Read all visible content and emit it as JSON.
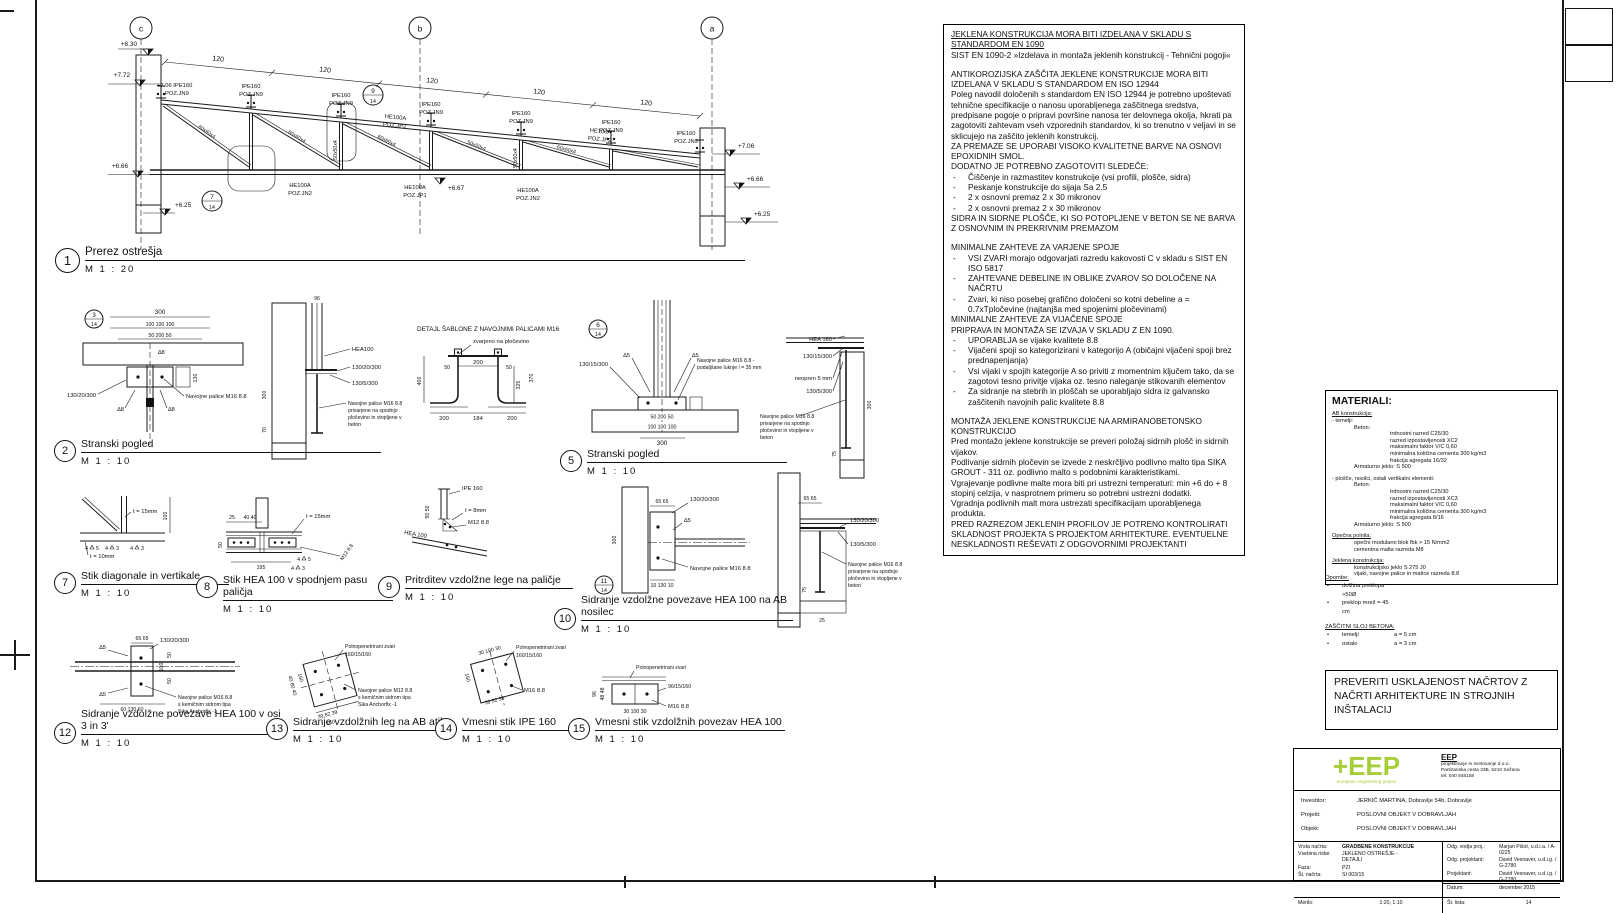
{
  "sheet": {
    "bg": "#ffffff",
    "line_color": "#1a1a1a",
    "accent_green": "#a6ce39"
  },
  "main": {
    "grid_c": "c",
    "grid_b": "b",
    "grid_a": "a",
    "dim120": "120",
    "lev_830": "+8.30",
    "lev_772": "+7.72",
    "lev_706": "+7.06",
    "lev_666": "+6.66",
    "lev_625": "+6.25",
    "lev_667": "+6.67",
    "lv706_ipe": "+7.06 IPE160",
    "purlin1": "IPE160",
    "purlin2": "POZ.JN9",
    "jn2a": "HE100A",
    "jn2b": "POZ.JN2",
    "jp1a": "HE100A",
    "jp1b": "POZ.JP1",
    "jp2a": "HE100A",
    "jp2b": "POZ.JP2",
    "d60": "60x60x4",
    "d50": "50x50x4"
  },
  "details": {
    "refs": {
      "r3": "3",
      "r6": "6",
      "r11": "11",
      "sheet": "14"
    },
    "d1": {
      "num": "1",
      "title": "Prerez ostrešja",
      "scale": "M  1 : 20"
    },
    "d2": {
      "num": "2",
      "title": "Stranski pogled",
      "scale": "M  1 : 10"
    },
    "d5": {
      "num": "5",
      "title": "Stranski pogled",
      "scale": "M  1 : 10"
    },
    "d7": {
      "num": "7",
      "title": "Stik diagonale in vertikale",
      "scale": "M  1 : 10"
    },
    "d8": {
      "num": "8",
      "title": "Stik HEA 100 v spodnjem pasu paličja",
      "scale": "M  1 : 10"
    },
    "d9": {
      "num": "9",
      "title": "Pritrditev vzdolžne lege na paličje",
      "scale": "M  1 : 10"
    },
    "d10": {
      "num": "10",
      "title": "Sidranje vzdolžne povezave HEA 100 na AB nosilec",
      "scale": "M  1 : 10"
    },
    "d12": {
      "num": "12",
      "title": "Sidranje vzdolžne povezave HEA 100 v osi 3 in 3'",
      "scale": "M  1 : 10"
    },
    "d13": {
      "num": "13",
      "title": "Sidranje vzdolžnih leg na AB atiko",
      "scale": "M  1 : 10"
    },
    "d14": {
      "num": "14",
      "title": "Vmesni stik IPE 160",
      "scale": "M  1 : 10"
    },
    "d15": {
      "num": "15",
      "title": "Vmesni stik vzdolžnih povezav HEA 100",
      "scale": "M  1 : 10"
    }
  },
  "sablona": {
    "title": "DETAJL ŠABLONE Z NAVOJNIMI PALICAMI M16",
    "weld_note": "zvarjeno na pločevino"
  },
  "ann": {
    "a300": "300",
    "a100x3": "100   100   100",
    "a50_200_50": "50   200   50",
    "a130_20_300": "130/20/300",
    "a130_5_300": "130/5/300",
    "a130_15_300": "130/15/300",
    "navm16": "Navojne palice M16 8.8",
    "priv_l2": "privarjene na spodnjo",
    "priv_l3": "pločevino in vtopljene v",
    "priv_l4": "beton",
    "podaljsane1": "Navojne palice M16 8.8 -",
    "podaljsane2": "podaljšane luknje l = 35 mm",
    "sika2": "s kemičnim sidrom tipa",
    "sika3": "Sika Anchorfix -1",
    "sika_m12": "Navojne palice M12 8.8",
    "hea100": "HEA100",
    "hea100s": "HEA 100",
    "hea160": "HEA 160",
    "ipe160": "IPE 160",
    "neopren": "neopren 5 mm",
    "t15": "t = 15mm",
    "t10": "t = 10mm",
    "t8": "t = 8mm",
    "m12": "M12 8.8",
    "m16": "M16 8.8",
    "poln": "Polnopenetrirani zvari",
    "p160": "160/15/160",
    "p96": "96/15/160",
    "a400": "400",
    "a325": "325",
    "a370": "370",
    "a200": "200",
    "a184": "184",
    "a50": "50",
    "a195": "195",
    "a25": "25",
    "a40_40": "40  40",
    "a100": "100",
    "a130": "130",
    "a70": "70",
    "a65_65": "65  65",
    "a60_130_60": "60  130  60",
    "a10_130_10": "10 130 10",
    "a30_100_30": "30 100 30",
    "a39_82_39": "39 82 39",
    "a40_80_40": "40 80 40",
    "a160": "160",
    "a96": "96",
    "a48_48": "48 48",
    "a75": "75",
    "a50_50": "50 50",
    "w5t": "∆5",
    "w8t": "∆8",
    "w4": "4",
    "w3": "3",
    "w5": "5"
  },
  "specs": {
    "lines": [
      {
        "s": "hu",
        "t": "JEKLENA KONSTRUKCIJA MORA BITI IZDELANA V SKLADU S STANDARDOM EN 1090"
      },
      {
        "s": "p",
        "t": "SIST EN 1090-2 »Izdelava in montaža jeklenih konstrukcij - Tehnični pogoji«"
      },
      {
        "s": "gap"
      },
      {
        "s": "p",
        "t": "ANTIKOROZIJSKA ZAŠČITA JEKLENE KONSTRUKCIJE MORA BITI IZDELANA V SKLADU S STANDARDOM EN ISO 12944"
      },
      {
        "s": "p",
        "t": "Poleg navodil določenih s standardom EN ISO 12944 je potrebno upoštevati tehnične specifikacije o nanosu uporabljenega zaščitnega sredstva, predpisane pogoje o pripravi površine nanosa ter delovnega okolja, hkrati pa zagotoviti zahtevam vseh vzporednih standardov, ki so trenutno v veljavi in se sklicujejo na zaščito jeklenih konstrukcij."
      },
      {
        "s": "p",
        "t": "ZA PREMAZE SE UPORABI VISOKO KVALITETNE BARVE NA OSNOVI EPOXIDNIH SMOL."
      },
      {
        "s": "p",
        "t": "DODATNO JE POTREBNO ZAGOTOVITI SLEDEČE:"
      },
      {
        "s": "li",
        "t": "Čiščenje in razmastitev konstrukcije (vsi profili, plošče, sidra)"
      },
      {
        "s": "li",
        "t": "Peskanje konstrukcije do sijaja Sa 2.5"
      },
      {
        "s": "li",
        "t": "2 x osnovni premaz 2 x 30 mikronov"
      },
      {
        "s": "li",
        "t": "2 x osnovni premaz 2 x 30 mikronov"
      },
      {
        "s": "p",
        "t": "SIDRA IN SIDRNE PLOŠČE, KI SO POTOPLJENE V BETON SE NE BARVA Z OSNOVNIM IN PREKRIVNIM PREMAZOM"
      },
      {
        "s": "gap"
      },
      {
        "s": "p",
        "t": "MINIMALNE ZAHTEVE ZA VARJENE SPOJE"
      },
      {
        "s": "li",
        "t": "VSI ZVARI morajo odgovarjati razredu kakovosti C v skladu s SIST EN ISO 5817"
      },
      {
        "s": "li",
        "t": "ZAHTEVANE DEBELINE IN OBLIKE ZVAROV SO DOLOČENE NA NAČRTU"
      },
      {
        "s": "li",
        "t": "Zvari, ki niso posebej grafično določeni so kotni debeline a = 0.7xTpločevine (najtanjša med spojenimi pločevinami)"
      },
      {
        "s": "p",
        "t": "MINIMALNE ZAHTEVE ZA VIJAČENE SPOJE"
      },
      {
        "s": "p",
        "t": "PRIPRAVA IN MONTAŽA SE IZVAJA V SKLADU Z EN 1090."
      },
      {
        "s": "li",
        "t": "UPORABLJA se vijake kvalitete 8.8"
      },
      {
        "s": "li",
        "t": "Vijačeni spoji so kategorizirani v kategorijo A (običajni vijačeni spoji brez prednapenjanja)"
      },
      {
        "s": "li",
        "t": "Vsi vijaki v spojih kategorije A so priviti z momentnim ključem tako, da se zagotovi tesno privitje vijaka oz. tesno naleganje stikovanih elementov"
      },
      {
        "s": "li",
        "t": "Za sidranje na stebrih in ploščah se uporabljajo sidra iz galvansko zaščitenih navojnih palic kvalitete 8.8"
      },
      {
        "s": "gap"
      },
      {
        "s": "p",
        "t": "MONTAŽA JEKLENE KONSTRUKCIJE NA ARMIRANOBETONSKO KONSTRUKCIJO"
      },
      {
        "s": "p",
        "t": "Pred montažo jeklene konstrukcije se preveri položaj sidrnih plošč in sidrnih vijakov."
      },
      {
        "s": "p",
        "t": "Podlivanje sidrnih pločevin se izvede z neskrčljivo podlivno malto tipa SIKA GROUT - 311 oz. podlivno malto s podobnimi karakteristikami."
      },
      {
        "s": "p",
        "t": "Vgrajevanje podlivne malte mora biti pri ustrezni temperaturi: min +6 do + 8 stopinj celzija, v nasprotnem primeru so potrebni ustrezni dodatki."
      },
      {
        "s": "p",
        "t": "Vgradnja podlivnih malt mora ustrezati specifikacijam uporabljenega produkta."
      },
      {
        "s": "p",
        "t": "PRED RAZREZOM JEKLENIH PROFILOV JE POTRENO KONTROLIRATI SKLADNOST PROJEKTA S PROJEKTOM ARHITEKTURE. EVENTUELNE NESKLADNOSTI REŠEVATI Z ODGOVORNIMI PROJEKTANTI"
      }
    ]
  },
  "materials": {
    "title": "MATERIALI:",
    "lines": [
      {
        "s": "hu",
        "t": "AB konstrukcija:"
      },
      {
        "s": "p",
        "t": "- temelji:"
      },
      {
        "s": "i1",
        "t": "Beton:"
      },
      {
        "s": "i2",
        "t": "trdnostni razred C25/30"
      },
      {
        "s": "i2",
        "t": "razred izpostavljenosti XC2"
      },
      {
        "s": "i2",
        "t": "maksimalni faktor V/C 0,60"
      },
      {
        "s": "i2",
        "t": "minimalna količina cementa 300 kg/m3"
      },
      {
        "s": "i2",
        "t": "frakcija agregata 16/32"
      },
      {
        "s": "i1",
        "t": "Armaturno jeklo: S 500"
      },
      {
        "s": "gap"
      },
      {
        "s": "p",
        "t": "- plošče, nosilci, ostali vertikalni elementi:"
      },
      {
        "s": "i1",
        "t": "Beton:"
      },
      {
        "s": "i2",
        "t": "trdnostni razred C25/30"
      },
      {
        "s": "i2",
        "t": "razred izpostavljenosti XC3"
      },
      {
        "s": "i2",
        "t": "maksimalni faktor V/C 0,60"
      },
      {
        "s": "i2",
        "t": "minimalna količina cementa 300 kg/m3"
      },
      {
        "s": "i2",
        "t": "frakcija agregata 8/16"
      },
      {
        "s": "i1",
        "t": "Armaturno jeklo: S 500"
      },
      {
        "s": "gap"
      },
      {
        "s": "hu",
        "t": "Opečna polnila:"
      },
      {
        "s": "i1",
        "t": "opečni modularni blok fbk > 15 N/mm2"
      },
      {
        "s": "i1",
        "t": "cementna malta razreda M8"
      },
      {
        "s": "gap"
      },
      {
        "s": "hu",
        "t": "Jeklena konstrukcija:"
      },
      {
        "s": "i1",
        "t": "konstrukcijsko jeklo S 275 J0"
      },
      {
        "s": "i1",
        "t": "vijaki, navojne palice in matice razreda 8.8"
      }
    ]
  },
  "notes": {
    "lines": [
      {
        "s": "hu",
        "t": "Opombe:"
      },
      {
        "s": "lib",
        "t": "dolžina preklopa >50Ø"
      },
      {
        "s": "lib",
        "t": "preklop mrež = 45 cm"
      },
      {
        "s": "gap"
      },
      {
        "s": "hu",
        "t": "ZAŠČITNI SLOJ BETONA:"
      },
      {
        "s": "li2",
        "t": "temelji",
        "v": "a = 5 cm"
      },
      {
        "s": "li2",
        "t": "ostalo",
        "v": "a = 3 cm"
      }
    ]
  },
  "verify": {
    "text": "PREVERITI USKLAJENOST NAČRTOV Z NAČRTI ARHITEKTURE IN STROJNIH INŠTALACIJ"
  },
  "titleblock": {
    "logo_text": "+EEP",
    "logo_tagline": "european engineering project",
    "company_name": "EEP",
    "company_l1": "projektiranje in svetovanje d.o.o.",
    "company_l2": "Partizanska cesta 33B, 6210 Sežana",
    "company_l3": "tel: 040 848158",
    "investitor_label": "Investitor:",
    "investitor": "JERKIČ MARTINA, Dobravlje 54b, Dobravlje",
    "projekt_label": "Projekt:",
    "projekt": "POSLOVNI OBJEKT V DOBRAVLJAH",
    "objekt_label": "Objekt:",
    "objekt": "POSLOVNI OBJEKT V DOBRAVLJAH",
    "vrsta_label": "Vrsta načrta:",
    "vrsta": "GRADBENE KONSTRUKCIJE",
    "vsebina_label": "Vsebina risbe:",
    "vsebina": "JEKLENO OSTREŠJE - DETAJLI",
    "faza_label": "Faza:",
    "faza": "PZI",
    "st_nacrta_label": "Št. načrta:",
    "st_nacrta": "SI 003/15",
    "merilo_label": "Merilo:",
    "merilo": "1:20, 1:10",
    "odg_vodja_label": "Odg. vodja proj.:",
    "odg_vodja": "Marjan Pišot, u.d.i.a. / A-0225",
    "odg_proj_label": "Odg. projektant:",
    "odg_proj": "David Vesnaver, u.d.i.g. / G-2780",
    "projektant_label": "Projektant:",
    "projektant": "David Vesnaver, u.d.i.g. / G-2780",
    "datum_label": "Datum:",
    "datum": "december 2015",
    "st_lista_label": "Št. lista:",
    "st_lista": "14"
  }
}
